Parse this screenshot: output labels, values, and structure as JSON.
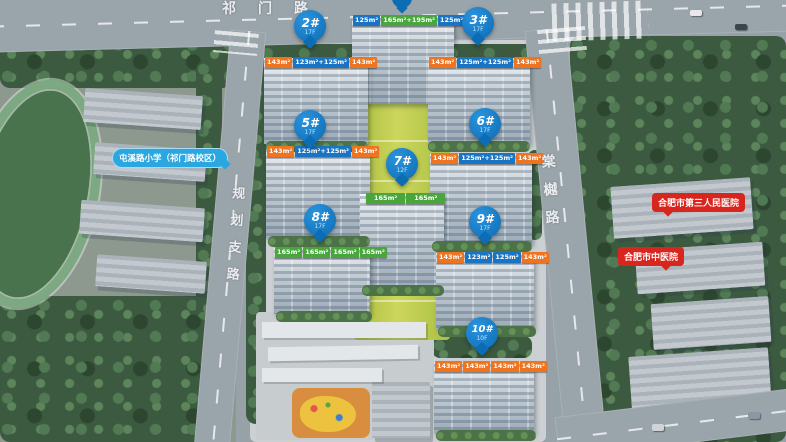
{
  "roads": {
    "top_label": "祁门路",
    "left_label": "规划支路",
    "right_label": "棠樾路"
  },
  "landmarks": {
    "school": "屯溪路小学（祁门路校区）",
    "hospital_third": "合肥市第三人民医院",
    "hospital_tcm": "合肥市中医院"
  },
  "buildings": {
    "b1": {
      "tags": [
        "125m²",
        "165m²+195m²",
        "125m²"
      ]
    },
    "b2": {
      "pin": "2#",
      "floors": "17F",
      "tags": [
        "143m²",
        "123m²+125m²",
        "143m²"
      ]
    },
    "b3": {
      "pin": "3#",
      "floors": "17F",
      "tags": [
        "143m²",
        "125m²+125m²",
        "143m²"
      ]
    },
    "b5": {
      "pin": "5#",
      "floors": "17F",
      "tags": [
        "143m²",
        "125m²+125m²",
        "143m²"
      ]
    },
    "b6": {
      "pin": "6#",
      "floors": "17F",
      "tags": [
        "143m²",
        "125m²+125m²",
        "143m²"
      ]
    },
    "b7": {
      "pin": "7#",
      "floors": "12F",
      "tags": [
        "165m²",
        "165m²"
      ]
    },
    "b8": {
      "pin": "8#",
      "floors": "17F",
      "tags": [
        "165m²",
        "165m²",
        "165m²",
        "165m²"
      ]
    },
    "b9": {
      "pin": "9#",
      "floors": "17F",
      "tags": [
        "143m²",
        "123m²",
        "125m²",
        "143m²"
      ]
    },
    "b10": {
      "pin": "10#",
      "floors": "10F",
      "tags": [
        "143m²",
        "143m²",
        "143m²",
        "143m²"
      ]
    }
  },
  "colors": {
    "pin_blue": "#0c6cb4",
    "tag_blue": "#1a74c4",
    "tag_orange": "#ef7420",
    "tag_green": "#48a63c",
    "bubble_red": "#d8251d",
    "bubble_blue": "#2aa7e0",
    "road_gray": "#9aa4ab",
    "tree_green": "#3c5a40",
    "lawn_green": "#c0cd52"
  }
}
